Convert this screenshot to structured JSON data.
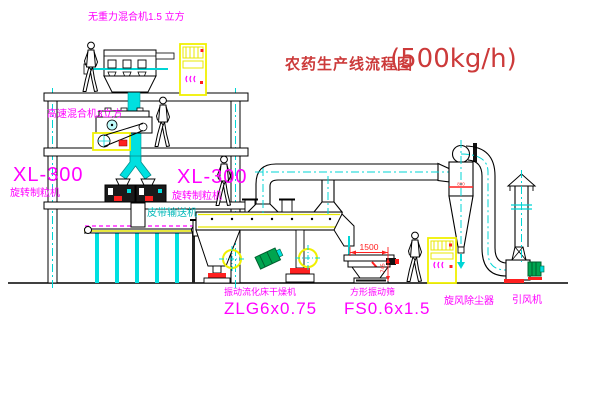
{
  "diagram": {
    "title": "农药生产线流程图",
    "capacity": "(500kg/h)"
  },
  "equipment_labels": {
    "gravity_mixer": "无重力混合机1.5 立方",
    "high_speed_mixer": "高速混合机3立方",
    "granulator_left_model": "XL-300",
    "granulator_left_name": "旋转制粒机",
    "granulator_right_model": "XL-300",
    "granulator_right_name": "旋转制粒机",
    "belt_conveyor": "皮带输送机",
    "dryer_name": "振动流化床干燥机",
    "dryer_model": "ZLG6x0.75",
    "sieve_name": "方形振动筛",
    "sieve_model": "FS0.6x1.5",
    "cyclone": "旋风除尘器",
    "fan": "引风机"
  },
  "dimensions": {
    "sieve_length": "1500",
    "sieve_height": "745",
    "cyclone_mark": "800"
  },
  "colors": {
    "label_magenta": "#FF00FF",
    "title_red": "#CC3A3A",
    "line_cyan": "#00D5D5",
    "highlight_yellow": "#F0F000",
    "dimension_red": "#FF2020",
    "motor_green": "#00A550",
    "line_black": "#000000"
  }
}
